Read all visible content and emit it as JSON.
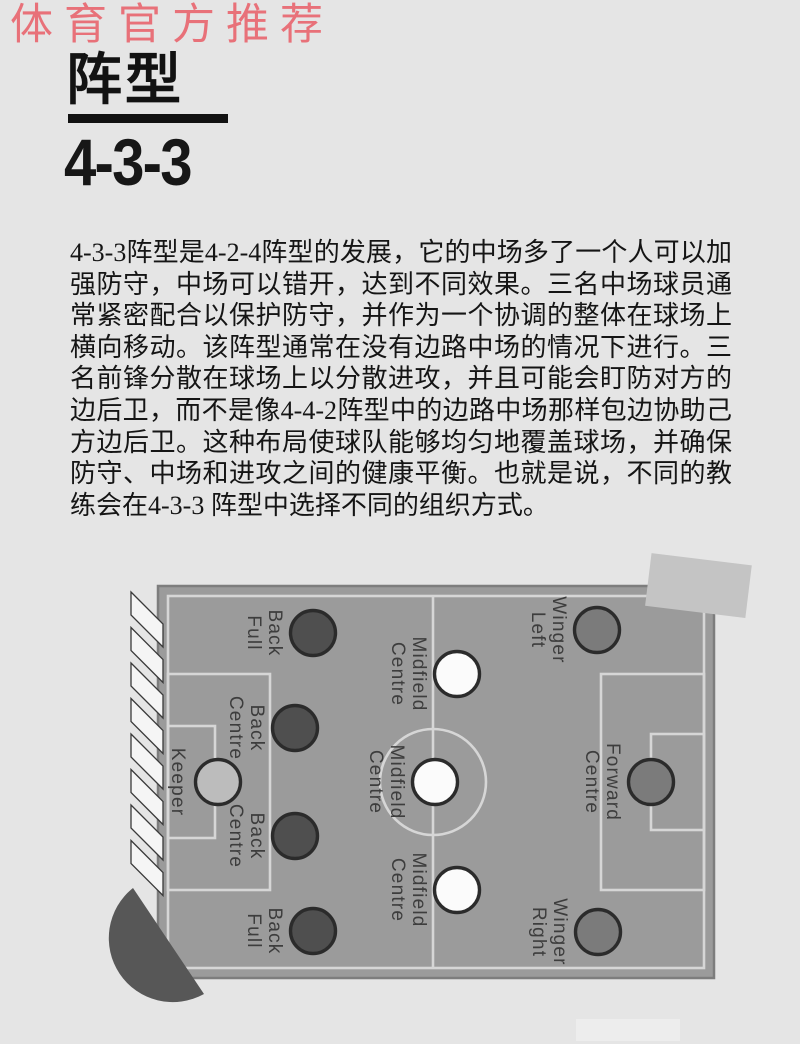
{
  "header": {
    "ribbon": "体育官方推荐",
    "ribbon_color": "#e87179",
    "title": "阵型",
    "subtitle": "4-3-3"
  },
  "article": {
    "paragraph": "4-3-3阵型是4-2-4阵型的发展，它的中场多了一个人可以加强防守，中场可以错开，达到不同效果。三名中场球员通常紧密配合以保护防守，并作为一个协调的整体在球场上横向移动。该阵型通常在没有边路中场的情况下进行。三名前锋分散在球场上以分散进攻，并且可能会盯防对方的边后卫，而不是像4-4-2阵型中的边路中场那样包边协助己方边后卫。这种布局使球队能够均匀地覆盖球场，并确保防守、中场和进攻之间的健康平衡。也就是说，不同的教练会在4-3-3 阵型中选择不同的组织方式。"
  },
  "diagram": {
    "formation": "4-3-3",
    "palette": {
      "pitch_fill": "#9b9b9b",
      "pitch_border": "#7d7d7d",
      "line_color": "#d6d6d6",
      "circle_stroke": "#2b2b2b",
      "keeper_fill": "#bcbcbc",
      "defender_fill": "#4f4f4f",
      "midfielder_fill": "#fbfbfb",
      "forward_fill": "#7b7b7b",
      "label_color": "#3d3d3d",
      "hatch_stroke": "#3a3a3a",
      "hatch_fill": "#f5f5f5",
      "pacman_fill": "#575757",
      "tilted_rect_fill": "#c4c4c4",
      "page_bg": "#e5e5e5"
    },
    "players": [
      {
        "id": "keeper",
        "label": "Keeper",
        "lines": [
          "Keeper"
        ],
        "x": 218,
        "y": 782,
        "type": "keeper"
      },
      {
        "id": "full-back-top",
        "label": "Full Back",
        "lines": [
          "Full",
          "Back"
        ],
        "x": 313,
        "y": 633,
        "type": "defender"
      },
      {
        "id": "centre-back-top",
        "label": "Centre Back",
        "lines": [
          "Centre",
          "Back"
        ],
        "x": 295,
        "y": 728,
        "type": "defender"
      },
      {
        "id": "centre-back-bottom",
        "label": "Centre Back",
        "lines": [
          "Centre",
          "Back"
        ],
        "x": 295,
        "y": 836,
        "type": "defender"
      },
      {
        "id": "full-back-bottom",
        "label": "Full Back",
        "lines": [
          "Full",
          "Back"
        ],
        "x": 313,
        "y": 931,
        "type": "defender"
      },
      {
        "id": "centre-midfield-top",
        "label": "Centre Midfield",
        "lines": [
          "Centre",
          "Midfield"
        ],
        "x": 457,
        "y": 674,
        "type": "midfielder"
      },
      {
        "id": "centre-midfield-mid",
        "label": "Centre Midfield",
        "lines": [
          "Centre",
          "Midfield"
        ],
        "x": 435,
        "y": 782,
        "type": "midfielder"
      },
      {
        "id": "centre-midfield-bot",
        "label": "Centre Midfield",
        "lines": [
          "Centre",
          "Midfield"
        ],
        "x": 457,
        "y": 890,
        "type": "midfielder"
      },
      {
        "id": "left-winger",
        "label": "Left Winger",
        "lines": [
          "Left",
          "Winger"
        ],
        "x": 597,
        "y": 630,
        "type": "forward"
      },
      {
        "id": "centre-forward",
        "label": "Centre Forward",
        "lines": [
          "Centre",
          "Forward"
        ],
        "x": 651,
        "y": 782,
        "type": "forward"
      },
      {
        "id": "right-winger",
        "label": "Right Winger",
        "lines": [
          "Right",
          "Winger"
        ],
        "x": 598,
        "y": 932,
        "type": "forward"
      }
    ]
  }
}
